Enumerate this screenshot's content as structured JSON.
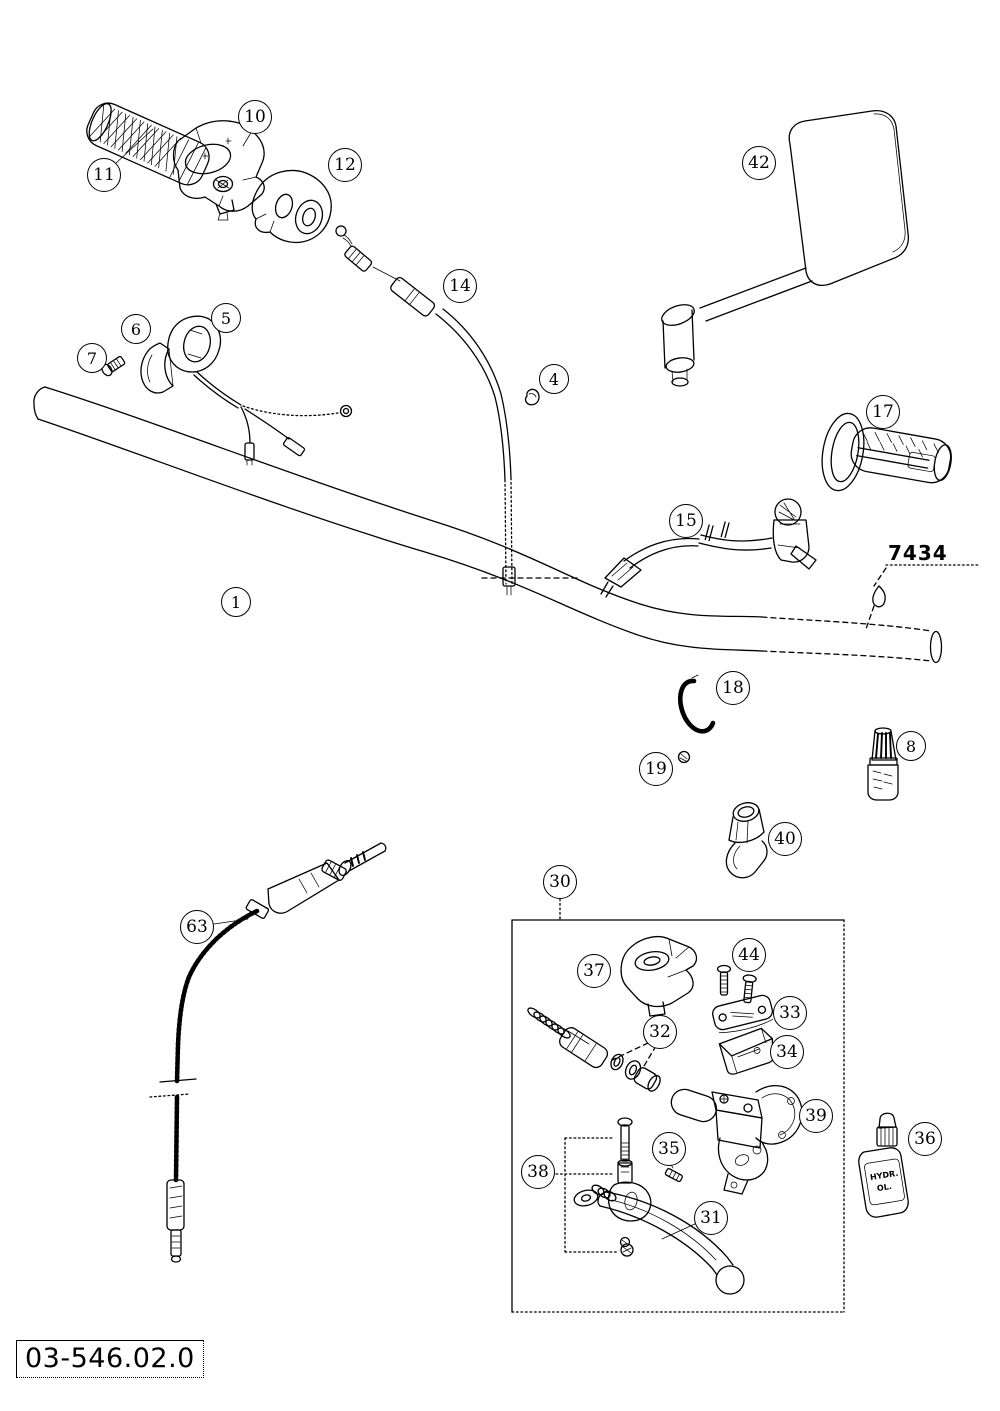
{
  "page": {
    "background": "#ffffff",
    "ink": "#000000"
  },
  "diagram": {
    "doc_number": "03-546.02.0",
    "ref_label": "7434",
    "oil_bottle": {
      "line1": "HYDR.",
      "line2": "OL."
    },
    "callouts": [
      {
        "label": "1",
        "x": 236,
        "y": 602
      },
      {
        "label": "4",
        "x": 554,
        "y": 379
      },
      {
        "label": "5",
        "x": 226,
        "y": 318
      },
      {
        "label": "6",
        "x": 136,
        "y": 329
      },
      {
        "label": "7",
        "x": 92,
        "y": 358
      },
      {
        "label": "8",
        "x": 911,
        "y": 746
      },
      {
        "label": "10",
        "x": 255,
        "y": 117
      },
      {
        "label": "11",
        "x": 104,
        "y": 175
      },
      {
        "label": "12",
        "x": 345,
        "y": 165
      },
      {
        "label": "14",
        "x": 460,
        "y": 286
      },
      {
        "label": "15",
        "x": 686,
        "y": 521
      },
      {
        "label": "17",
        "x": 883,
        "y": 412
      },
      {
        "label": "18",
        "x": 733,
        "y": 688
      },
      {
        "label": "19",
        "x": 656,
        "y": 769
      },
      {
        "label": "30",
        "x": 560,
        "y": 882
      },
      {
        "label": "31",
        "x": 711,
        "y": 1218
      },
      {
        "label": "32",
        "x": 660,
        "y": 1032
      },
      {
        "label": "33",
        "x": 790,
        "y": 1013
      },
      {
        "label": "34",
        "x": 787,
        "y": 1052
      },
      {
        "label": "35",
        "x": 669,
        "y": 1149
      },
      {
        "label": "36",
        "x": 925,
        "y": 1139
      },
      {
        "label": "37",
        "x": 594,
        "y": 971
      },
      {
        "label": "38",
        "x": 538,
        "y": 1172
      },
      {
        "label": "39",
        "x": 816,
        "y": 1116
      },
      {
        "label": "40",
        "x": 785,
        "y": 839
      },
      {
        "label": "42",
        "x": 759,
        "y": 163
      },
      {
        "label": "44",
        "x": 749,
        "y": 955
      },
      {
        "label": "63",
        "x": 197,
        "y": 927
      }
    ]
  }
}
